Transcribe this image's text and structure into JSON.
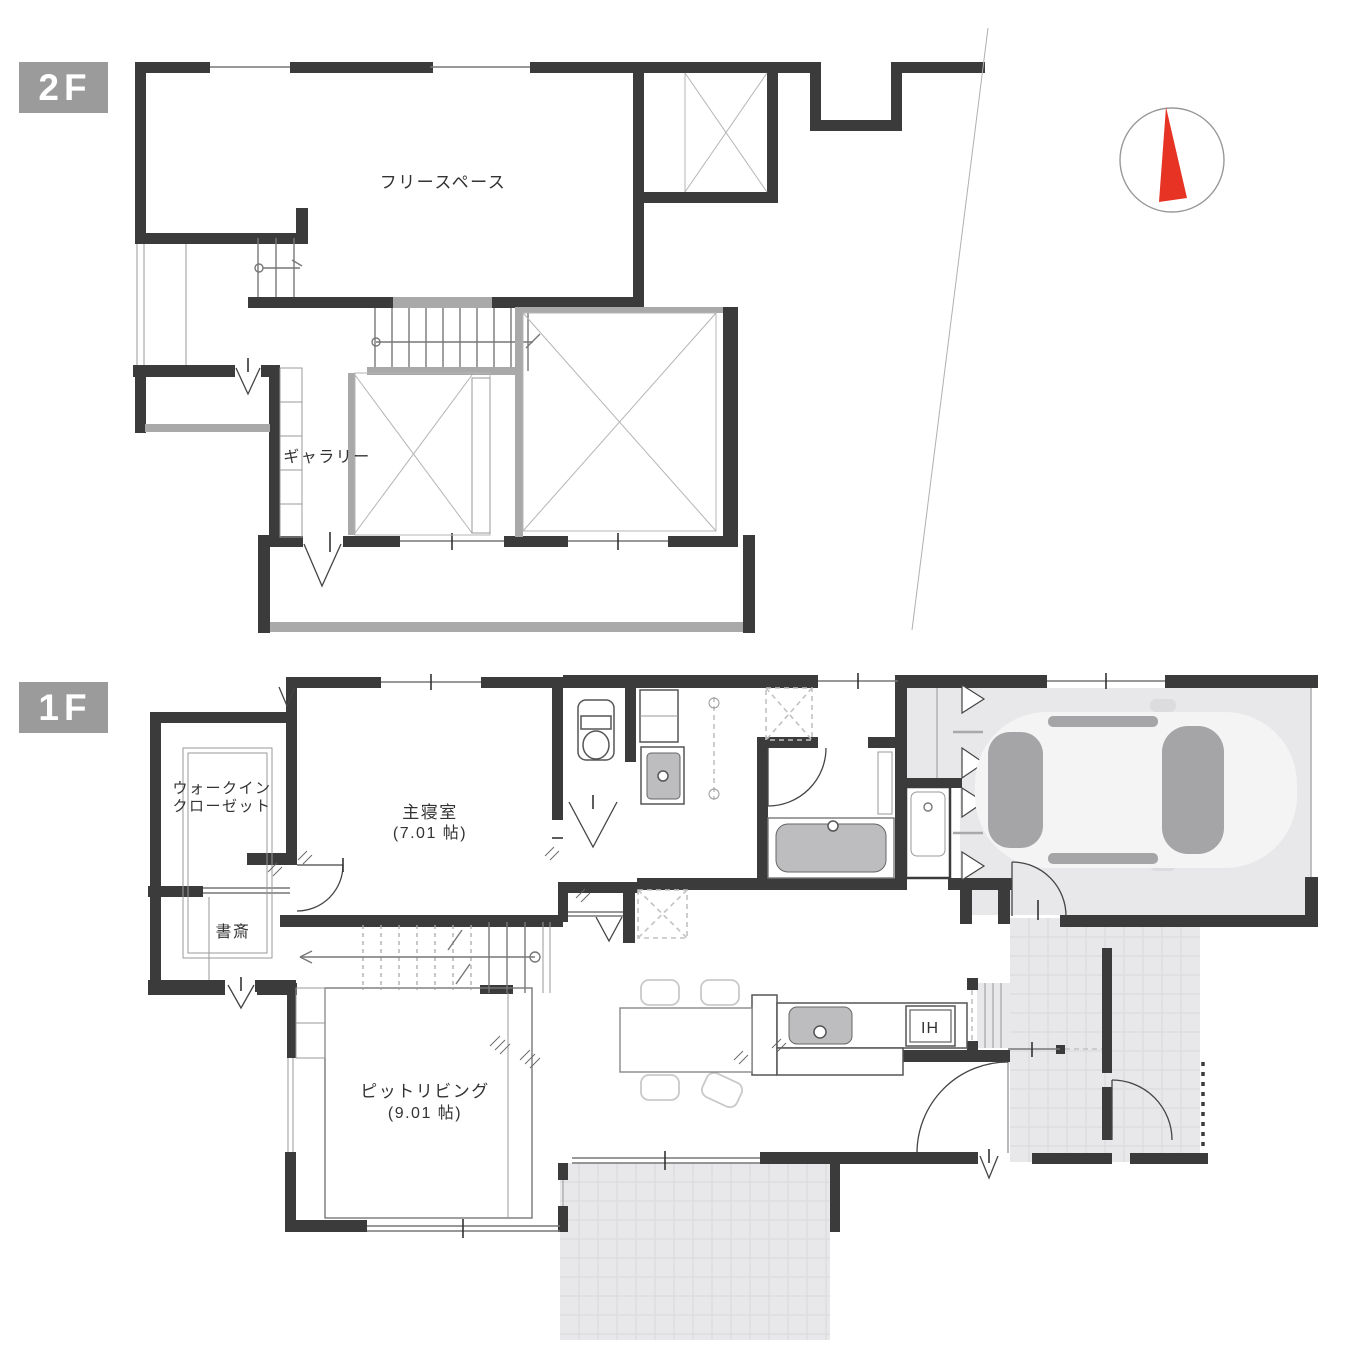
{
  "colors": {
    "wall": "#3b3b3b",
    "accent": "#a9a9a9",
    "floor": "#e8e8ea",
    "tileline": "#d9d9db",
    "fixture": "#bdbdbf",
    "glass": "#a5a5a7",
    "carbody": "#f4f4f5",
    "compassred": "#e63323",
    "ink": "#333333",
    "badgebg": "#9b9b9b",
    "badgetxt": "#ffffff"
  },
  "floor2": {
    "badge": "2F",
    "free_space": "フリースペース",
    "gallery": "ギャラリー"
  },
  "floor1": {
    "badge": "1F",
    "walk_in_closet": [
      "ウォークイン",
      "クローゼット"
    ],
    "master_bedroom": [
      "主寝室",
      "(7.01 帖)"
    ],
    "study": "書斎",
    "pit_living": [
      "ピットリビング",
      "(9.01 帖)"
    ],
    "ih": "IH"
  }
}
